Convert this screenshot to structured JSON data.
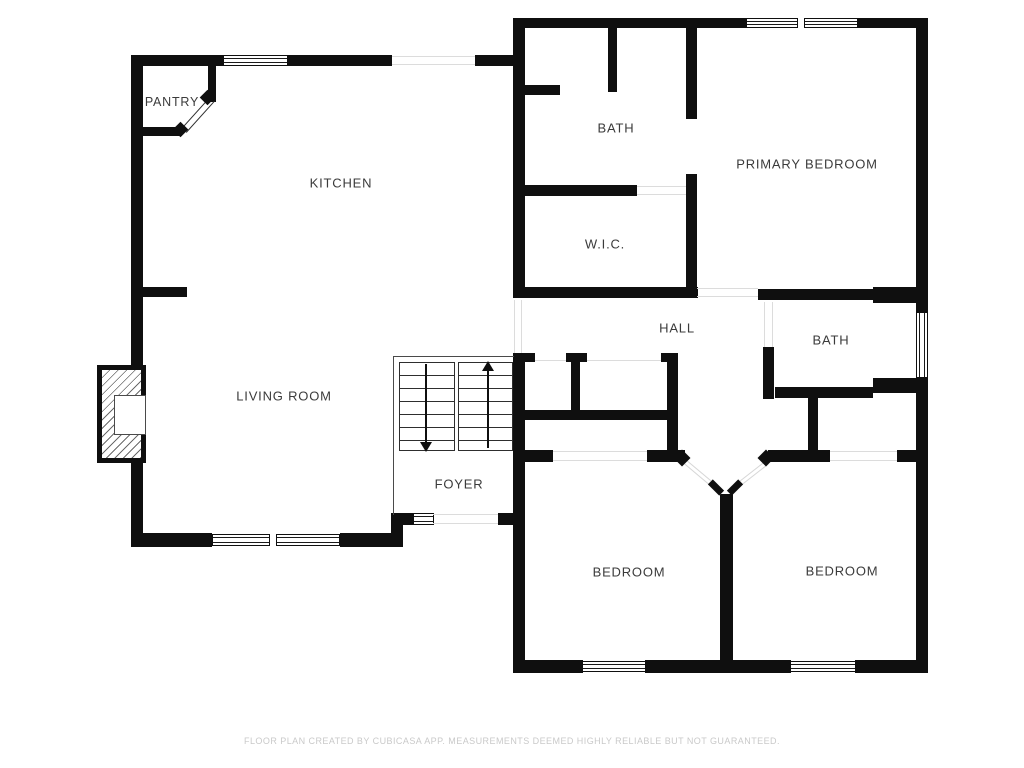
{
  "title": "Floor plan",
  "rooms": [
    {
      "id": "pantry",
      "label": "PANTRY"
    },
    {
      "id": "kitchen",
      "label": "KITCHEN"
    },
    {
      "id": "bath-upper",
      "label": "BATH"
    },
    {
      "id": "wic",
      "label": "W.I.C."
    },
    {
      "id": "primary-bedroom",
      "label": "PRIMARY BEDROOM"
    },
    {
      "id": "hall",
      "label": "HALL"
    },
    {
      "id": "bath-right",
      "label": "BATH"
    },
    {
      "id": "living-room",
      "label": "LIVING ROOM"
    },
    {
      "id": "foyer",
      "label": "FOYER"
    },
    {
      "id": "bedroom-left",
      "label": "BEDROOM"
    },
    {
      "id": "bedroom-right",
      "label": "BEDROOM"
    }
  ],
  "footer": {
    "disclaimer": "FLOOR PLAN CREATED BY CUBICASA APP. MEASUREMENTS DEEMED HIGHLY RELIABLE BUT NOT GUARANTEED."
  },
  "colors": {
    "wall": "#0f0f0f",
    "label": "#3b3b3b",
    "footer_text": "#c9c9c9",
    "door_line": "#dcdcdc",
    "background": "#ffffff"
  }
}
